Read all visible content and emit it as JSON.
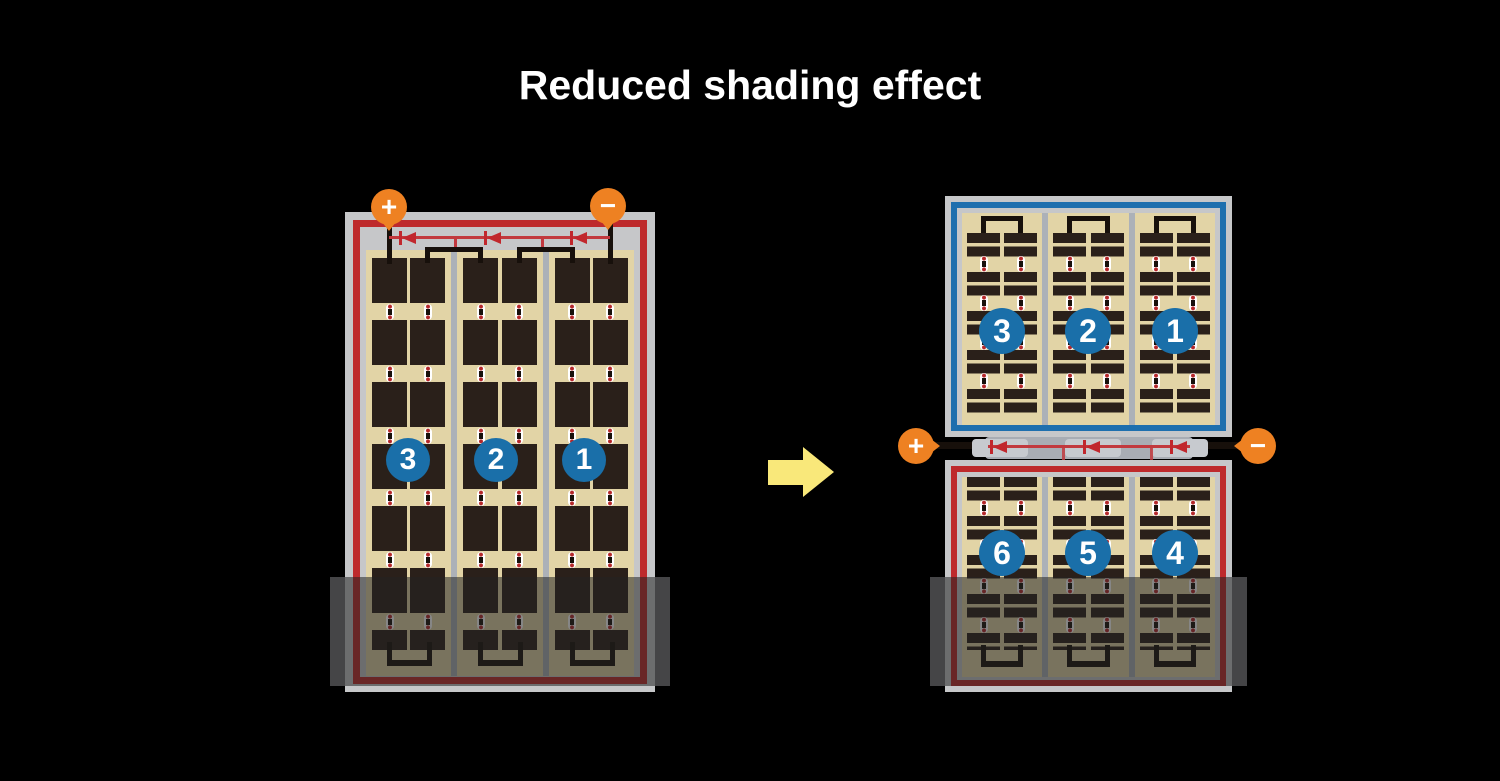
{
  "title": "Reduced shading effect",
  "modules": {
    "before": {
      "plus": "+",
      "minus": "−",
      "strings": [
        "3",
        "2",
        "1"
      ]
    },
    "after": {
      "plus": "+",
      "minus": "−",
      "top_strings": [
        "3",
        "2",
        "1"
      ],
      "bottom_strings": [
        "6",
        "5",
        "4"
      ]
    }
  },
  "colors": {
    "background": "#000000",
    "module_frame": "#C6C7C9",
    "border_red": "#BE2A2C",
    "border_blue": "#1E6FAE",
    "cell_dark": "#2A201A",
    "cell_background": "#E2D4A6",
    "badge_blue": "#1A6FA9",
    "terminal_orange": "#EE8122",
    "diode_red": "#C1272D",
    "arrow_yellow": "#F9E87A",
    "shade_overlay": "rgba(35,35,35,0.55)"
  }
}
